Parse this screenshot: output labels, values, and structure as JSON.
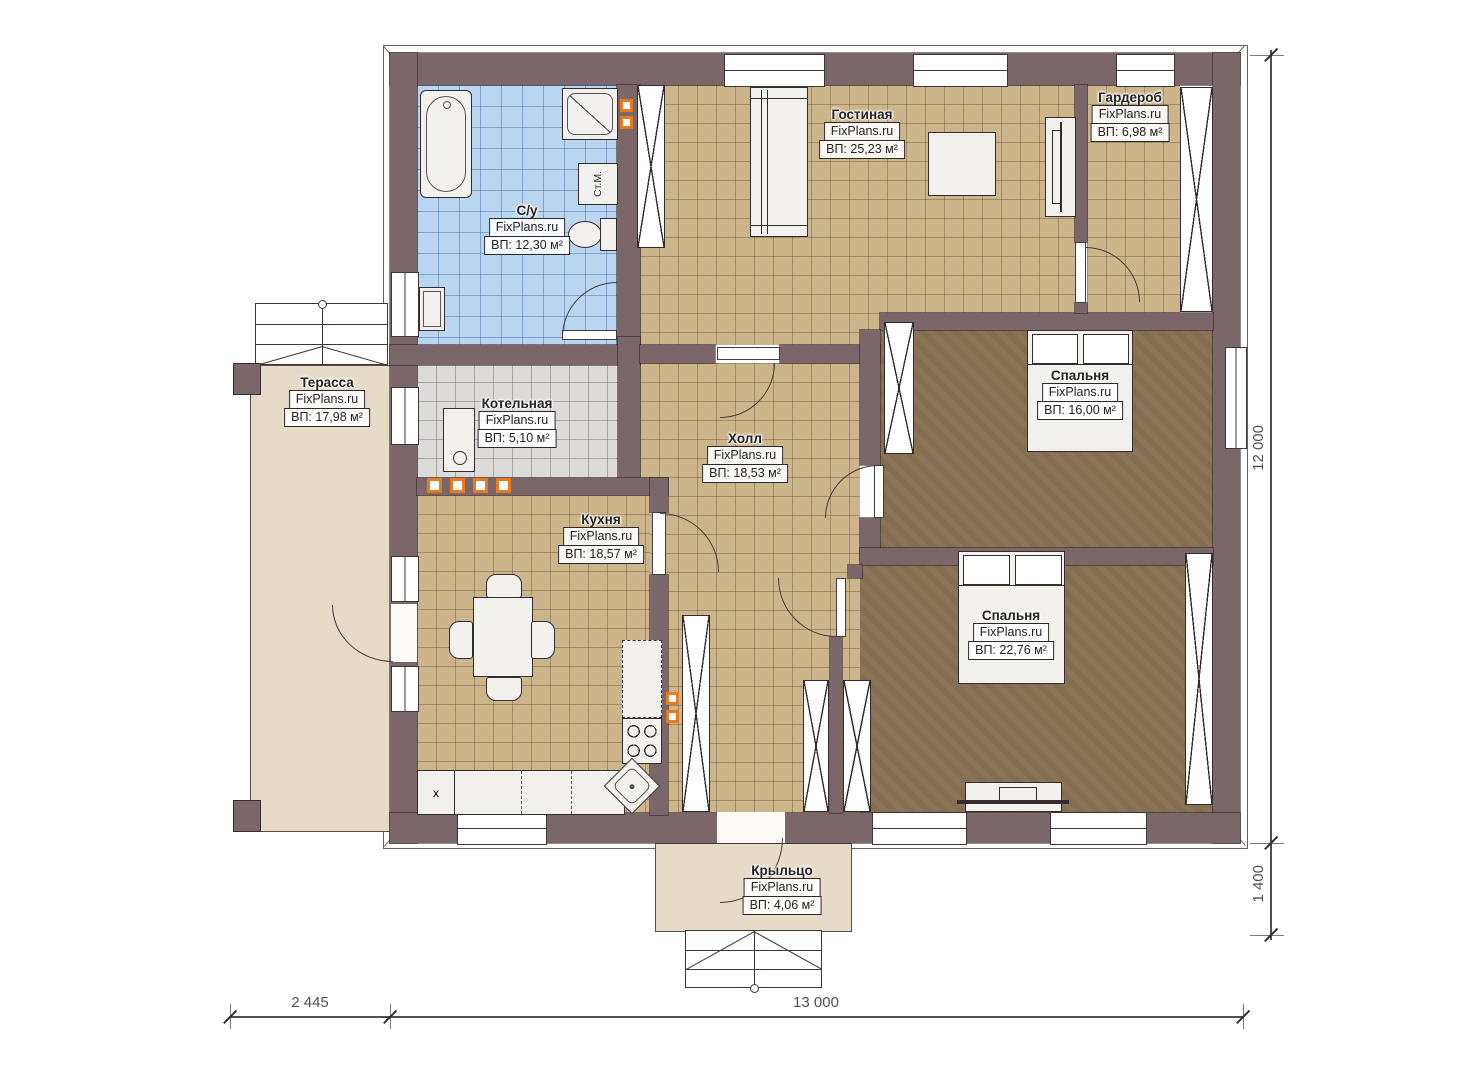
{
  "rooms": {
    "bathroom": {
      "name": "С/у",
      "brand": "FixPlans.ru",
      "area": "ВП: 12,30 м²"
    },
    "living": {
      "name": "Гостиная",
      "brand": "FixPlans.ru",
      "area": "ВП: 25,23 м²"
    },
    "wardrobe": {
      "name": "Гардероб",
      "brand": "FixPlans.ru",
      "area": "ВП: 6,98 м²"
    },
    "terrace": {
      "name": "Терасса",
      "brand": "FixPlans.ru",
      "area": "ВП: 17,98 м²"
    },
    "boiler": {
      "name": "Котельная",
      "brand": "FixPlans.ru",
      "area": "ВП: 5,10 м²"
    },
    "hall": {
      "name": "Холл",
      "brand": "FixPlans.ru",
      "area": "ВП: 18,53 м²"
    },
    "kitchen": {
      "name": "Кухня",
      "brand": "FixPlans.ru",
      "area": "ВП: 18,57 м²"
    },
    "bedroom1": {
      "name": "Спальня",
      "brand": "FixPlans.ru",
      "area": "ВП: 16,00 м²"
    },
    "bedroom2": {
      "name": "Спальня",
      "brand": "FixPlans.ru",
      "area": "ВП: 22,76 м²"
    },
    "porch": {
      "name": "Крыльцо",
      "brand": "FixPlans.ru",
      "area": "ВП: 4,06 м²"
    }
  },
  "fixtures": {
    "washing_machine": "Ст.М.",
    "kitchen_unit_x": "x"
  },
  "dimensions": {
    "left_offset": "2 445",
    "width_total": "13 000",
    "height_total": "12 000",
    "porch_depth": "1 400"
  },
  "colors": {
    "wall": "#7b6669",
    "floor_tan": "#ccb58a",
    "floor_blue": "#b9d5ef",
    "floor_gray": "#dcdbda",
    "floor_brown": "#8b7355",
    "outdoor": "#e6dbc7",
    "accent": "#e87a22",
    "ink": "#262122"
  }
}
